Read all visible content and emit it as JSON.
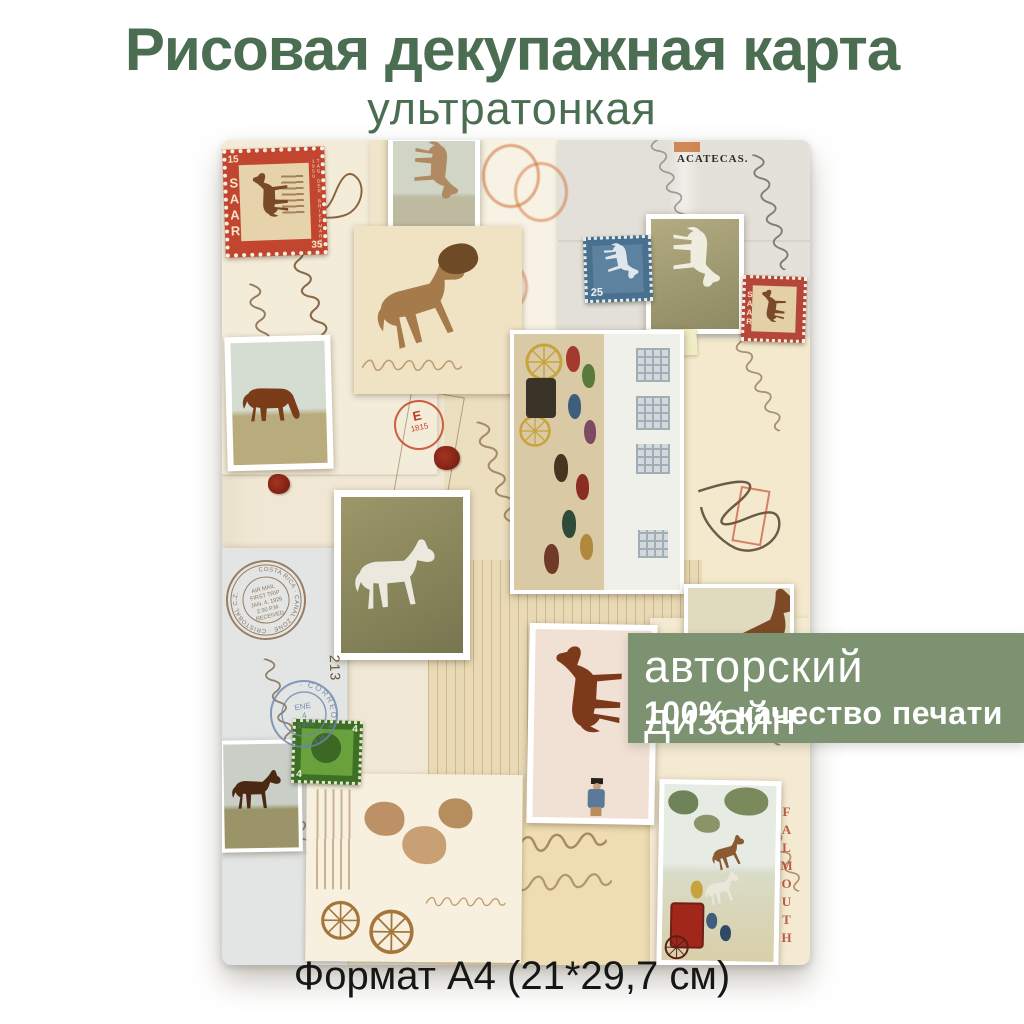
{
  "header": {
    "title": "Рисовая декупажная карта",
    "subtitle": "ультратонкая"
  },
  "banner": {
    "line1": "авторский дизайн",
    "line2": "100% качество печати"
  },
  "footer": {
    "format": "Формат А4 (21*29,7 см)"
  },
  "collage": {
    "envelope_print": "ACATECAS.",
    "falmouth": "FALMOUTH",
    "note_number": "213",
    "saar_stamp": {
      "value_left": "15",
      "name": "SAAR",
      "value_right": "35",
      "edge_text": "TAG DER BRIEFMARKE 1950"
    },
    "saar_stamp_small": {
      "name": "SAAR"
    },
    "blue_stamp": {
      "value": "25"
    },
    "green_stamp": {
      "value": "4"
    },
    "red_postmark": {
      "letter": "E",
      "year": "1815"
    },
    "blue_postmark": {
      "ring": "· CORREO AEREO ·",
      "line1": "ENE",
      "line2": "4",
      "line3": "1920"
    },
    "brown_postmark": {
      "ring": "COSTA RICA · CANAL ZONE · CRISTOBAL C.Z.",
      "lines": [
        "AIR MAIL",
        "FIRST TRIP",
        "JAN. 4, 1926",
        "2:30 P.M.",
        "RECEIVED"
      ]
    }
  },
  "colors": {
    "title_green": "#4b6d52",
    "banner_green": "#7c9271",
    "stamp_red": "#c2452f",
    "falmouth_red": "#b5452e",
    "postmark_blue": "#6b86ad",
    "postmark_brown": "#8a6a48",
    "wax_red": "#8c2718"
  }
}
